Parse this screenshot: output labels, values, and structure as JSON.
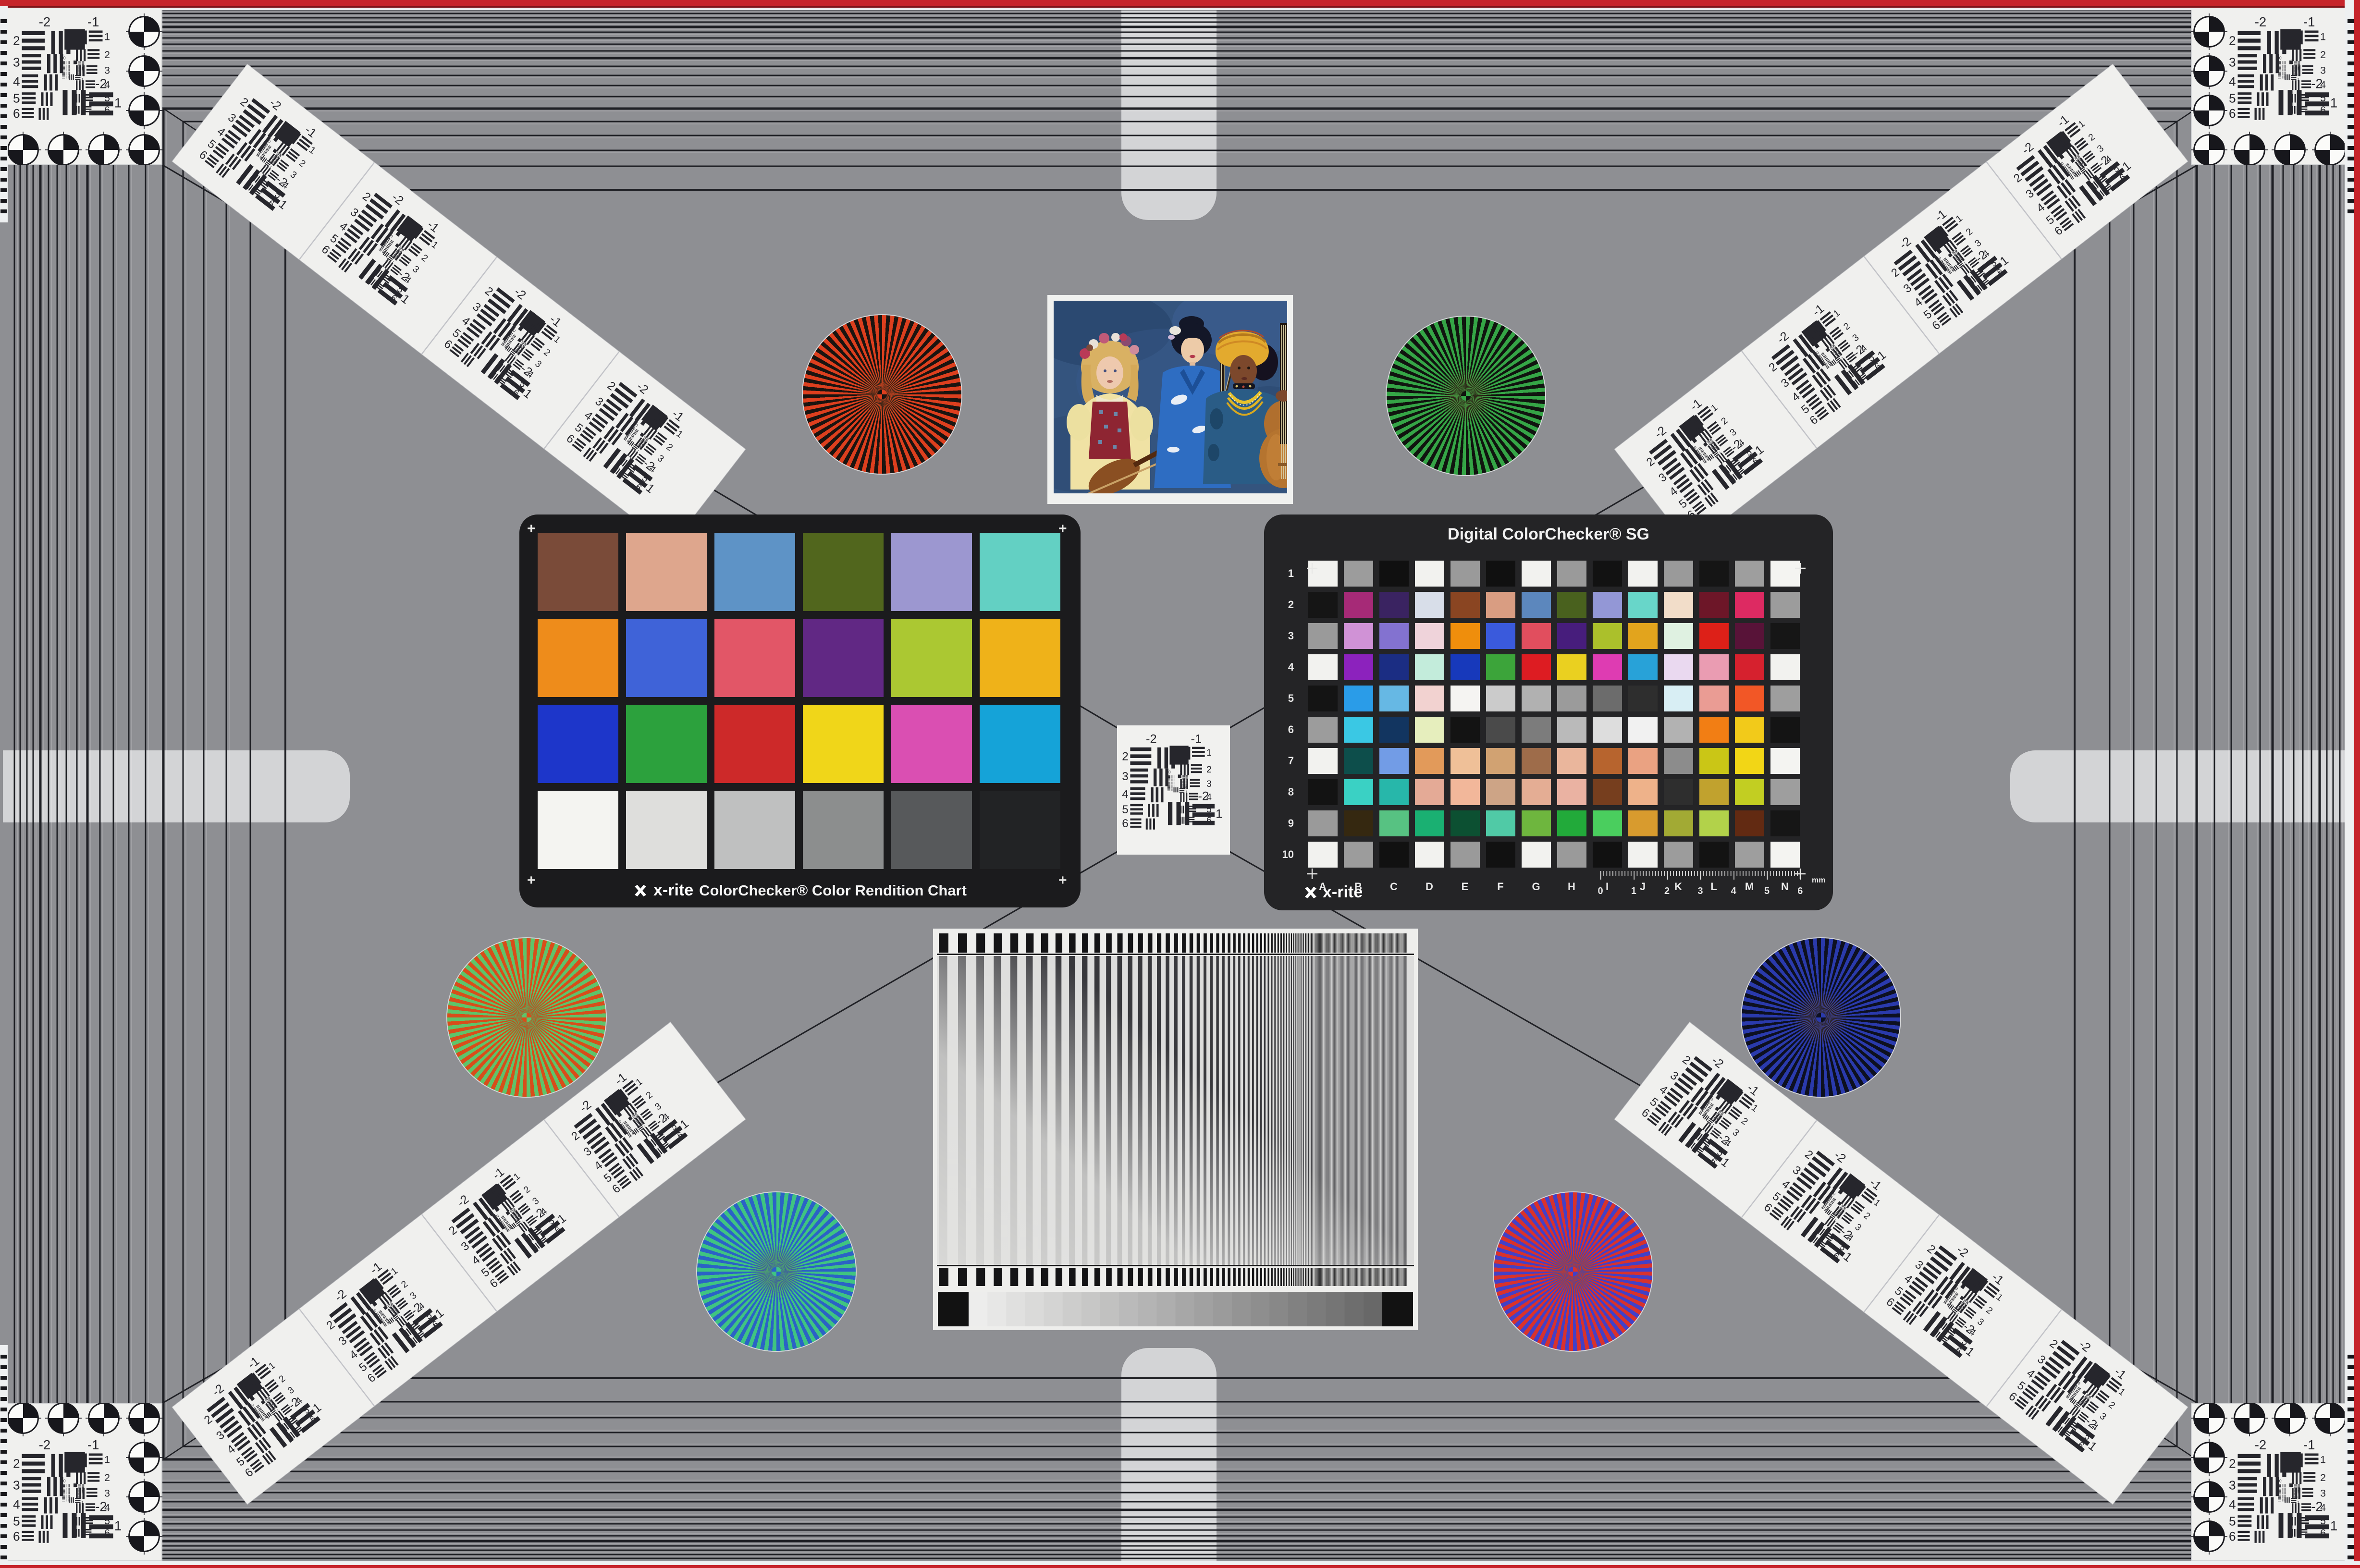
{
  "scene": {
    "background": "#8e8f93",
    "frame_line": "#1e1f24",
    "card_white": "#f0f0ee",
    "red_border": "#c6242b",
    "pill": "#d3d4d6"
  },
  "colorchecker": {
    "logo": "x-rite",
    "label": "ColorChecker® Color Rendition Chart",
    "rows": 4,
    "cols": 6,
    "patches": [
      "#7a4b39",
      "#dea68d",
      "#5e93c6",
      "#51661d",
      "#9c97d0",
      "#63d0c3",
      "#ee8c1b",
      "#3f63d8",
      "#e25667",
      "#612884",
      "#abc832",
      "#efb219",
      "#1d36ca",
      "#2ca13d",
      "#cd2929",
      "#f0d619",
      "#da4fb2",
      "#15a3d8",
      "#f4f4f1",
      "#dededc",
      "#bfc0c0",
      "#8c8e8e",
      "#57595b",
      "#222325"
    ]
  },
  "colorchecker_sg": {
    "title": "Digital ColorChecker® SG",
    "logo": "x-rite",
    "row_labels": [
      "1",
      "2",
      "3",
      "4",
      "5",
      "6",
      "7",
      "8",
      "9",
      "10"
    ],
    "col_labels": [
      "A",
      "B",
      "C",
      "D",
      "E",
      "F",
      "G",
      "H",
      "I",
      "J",
      "K",
      "L",
      "M",
      "N"
    ],
    "ruler": {
      "numbers": [
        "0",
        "1",
        "2",
        "3",
        "4",
        "5",
        "6"
      ],
      "unit": "mm"
    },
    "patches": [
      [
        "#f2f2ef",
        "#9c9c9c",
        "#101010",
        "#f2f2ef",
        "#9a9a9a",
        "#101010",
        "#f2f2ef",
        "#9a9a9a",
        "#121212",
        "#f2f2ef",
        "#9a9a9a",
        "#151515",
        "#9e9e9e",
        "#f4f4f1"
      ],
      [
        "#151515",
        "#a62a77",
        "#3a2361",
        "#d8dee9",
        "#8a4522",
        "#d99d82",
        "#5c87bd",
        "#49611e",
        "#9397d6",
        "#68d6c9",
        "#f2ddc9",
        "#6d1628",
        "#dd2a62",
        "#9c9c9c"
      ],
      [
        "#9a9a9a",
        "#d092d6",
        "#8372d0",
        "#efd3da",
        "#ef8e0c",
        "#3a5adc",
        "#e14e5e",
        "#471d7c",
        "#abc02b",
        "#e2a41d",
        "#dff1e1",
        "#dd2018",
        "#581338",
        "#161616"
      ],
      [
        "#f2f2ef",
        "#8c22bd",
        "#1b2d83",
        "#c3ecdb",
        "#1739bb",
        "#3ca43a",
        "#dd1c22",
        "#ead020",
        "#de3cb2",
        "#28a2d8",
        "#ead9f0",
        "#ea9cb2",
        "#d6212e",
        "#f2f2ef"
      ],
      [
        "#141414",
        "#2a9ce8",
        "#66b8e4",
        "#f2d2d0",
        "#f5f4f2",
        "#cbcbcb",
        "#b1b1b1",
        "#9b9b9b",
        "#6c6c6c",
        "#2e2e2e",
        "#d8eef4",
        "#ea9c94",
        "#f25726",
        "#9e9e9e"
      ],
      [
        "#9c9c9c",
        "#3ac8e4",
        "#123560",
        "#e6eebd",
        "#131313",
        "#4a4a4a",
        "#7c7c7c",
        "#bababa",
        "#dddddd",
        "#f1f1f1",
        "#b2b2b2",
        "#f27e14",
        "#f2ca1a",
        "#141414"
      ],
      [
        "#f2f2ef",
        "#0d4e4b",
        "#729ce6",
        "#e29a5a",
        "#efc098",
        "#d1a272",
        "#9e6c4a",
        "#eab69c",
        "#b7642e",
        "#eaa282",
        "#8c8c8c",
        "#cac616",
        "#f2d616",
        "#f4f4f1"
      ],
      [
        "#131313",
        "#3ad1c4",
        "#27b7aa",
        "#e4aa96",
        "#f2b79a",
        "#cda486",
        "#e4ad94",
        "#eab2a2",
        "#763e1e",
        "#eeb28a",
        "#2e2e2e",
        "#c1a22e",
        "#c2ce22",
        "#9e9e9e"
      ],
      [
        "#9a9a9a",
        "#352810",
        "#57c282",
        "#1ab072",
        "#0c5032",
        "#50caa6",
        "#6eb63e",
        "#22aa3a",
        "#4ace5e",
        "#d89b2e",
        "#a2aa34",
        "#b2d24a",
        "#622a12",
        "#161616"
      ],
      [
        "#f2f2ef",
        "#9c9c9c",
        "#111111",
        "#f2f2ef",
        "#9a9a9a",
        "#111111",
        "#f2f2ef",
        "#9a9a9a",
        "#111111",
        "#f2f2ef",
        "#9c9c9c",
        "#131313",
        "#9e9e9e",
        "#f4f4f1"
      ]
    ]
  },
  "usaf_target": {
    "top_labels": [
      "-2",
      "-1"
    ],
    "left_labels": [
      "2",
      "3",
      "4",
      "5",
      "6"
    ],
    "right_labels": [
      "1",
      "2",
      "3",
      "4",
      "5",
      "6"
    ],
    "bottom_labels": [
      "-2",
      "1"
    ],
    "center_labels": [
      "0",
      "1"
    ]
  },
  "starbursts": [
    {
      "name": "red-black",
      "colors": [
        "#dd3f1e",
        "#1a1410"
      ],
      "position": "upper-left"
    },
    {
      "name": "green-black",
      "colors": [
        "#35a546",
        "#10140f"
      ],
      "position": "upper-right"
    },
    {
      "name": "red-green",
      "colors": [
        "#d84d1a",
        "#5ec46a"
      ],
      "position": "mid-left"
    },
    {
      "name": "blue-black",
      "colors": [
        "#2a3aac",
        "#0d1020"
      ],
      "position": "mid-right"
    },
    {
      "name": "green-blue",
      "colors": [
        "#3fc481",
        "#2b62c6"
      ],
      "position": "lower-left"
    },
    {
      "name": "red-blue",
      "colors": [
        "#d8322c",
        "#4340c6"
      ],
      "position": "lower-right"
    }
  ],
  "sweep_chart": {
    "bar_color": "#38383c",
    "background": "#eeeeec",
    "grayscale_steps": [
      "#ededec",
      "#e7e7e6",
      "#e0e0df",
      "#dadad9",
      "#d4d4d3",
      "#cdcdcc",
      "#c7c7c6",
      "#c1c1c0",
      "#bababa",
      "#b4b4b4",
      "#aeaeae",
      "#a7a7a7",
      "#a1a1a1",
      "#9b9b9b",
      "#949494",
      "#8e8e8e",
      "#888888",
      "#818181",
      "#7b7b7b",
      "#757575",
      "#6e6e6e",
      "#686868"
    ]
  },
  "photo": {
    "backdrop": "#34547e"
  }
}
